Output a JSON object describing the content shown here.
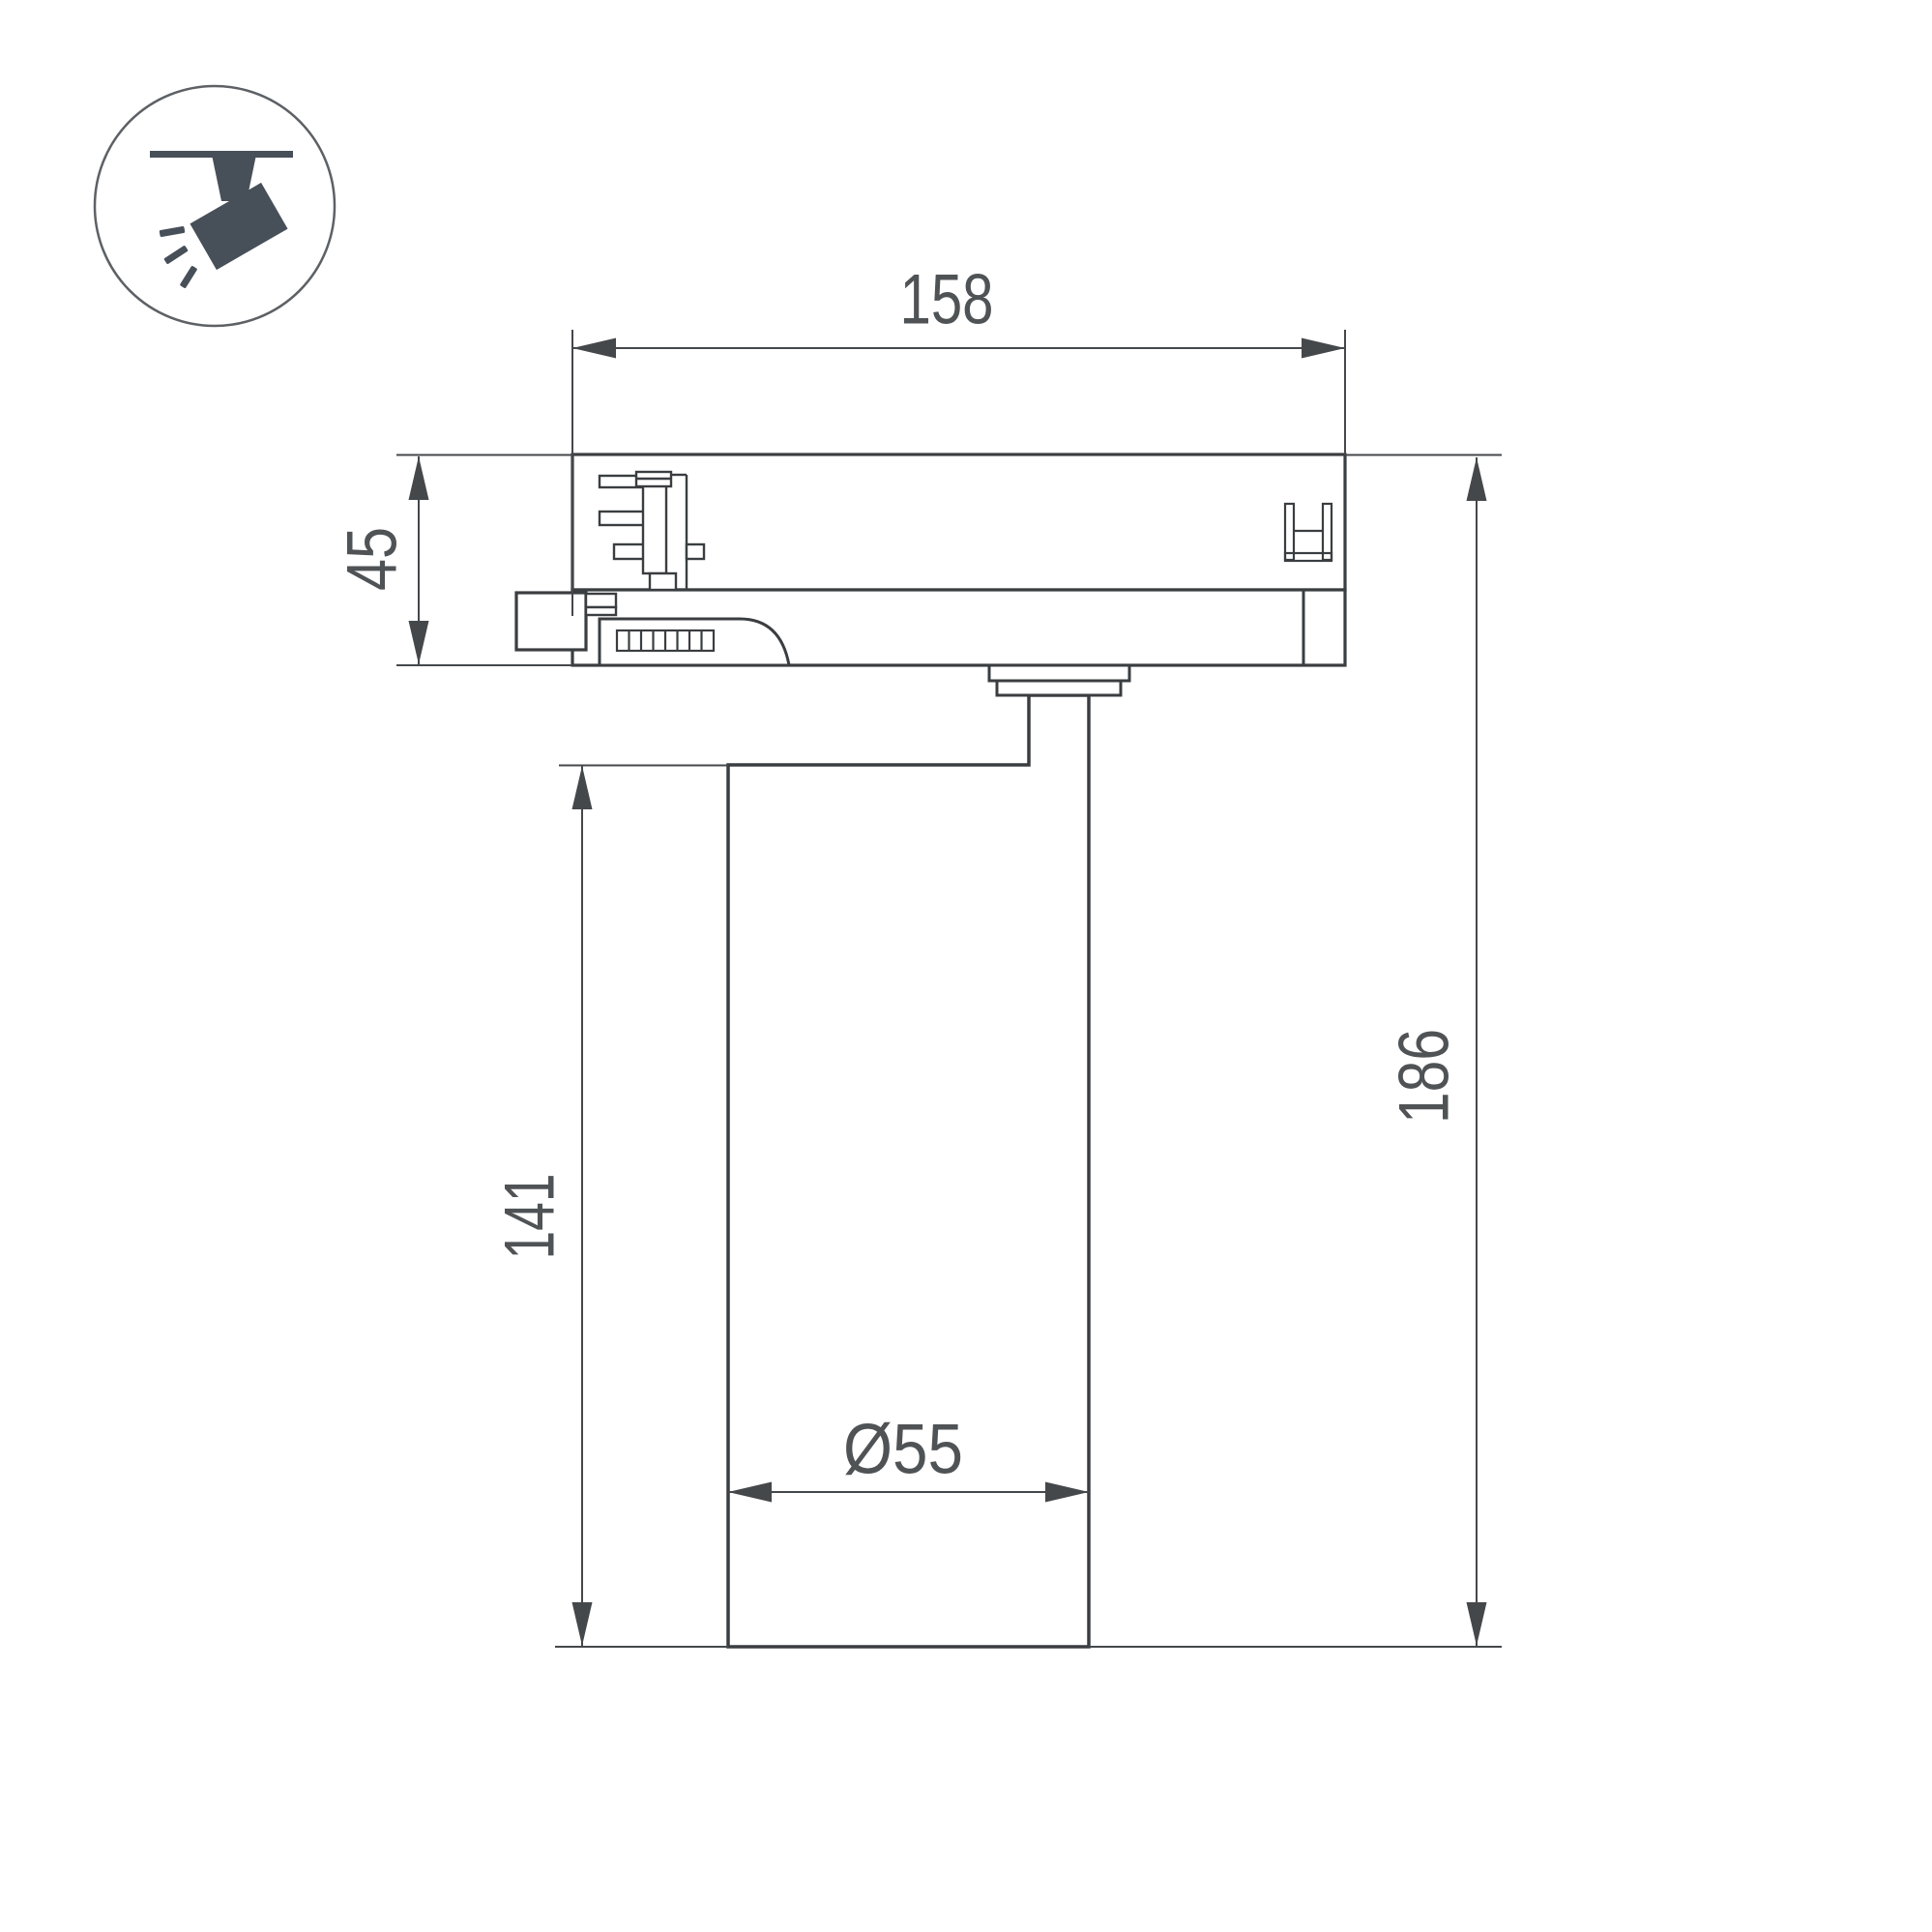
{
  "icon": {
    "name": "track-spotlight"
  },
  "dimensions": {
    "track_width": "158",
    "adapter_height": "45",
    "body_height": "141",
    "total_height": "186",
    "body_diameter": "Ø55"
  },
  "colors": {
    "line": "#3a3e41",
    "dimension_line": "#44484b",
    "label_text": "#4f5356",
    "icon_fill": "#474f58",
    "background": "#ffffff"
  }
}
